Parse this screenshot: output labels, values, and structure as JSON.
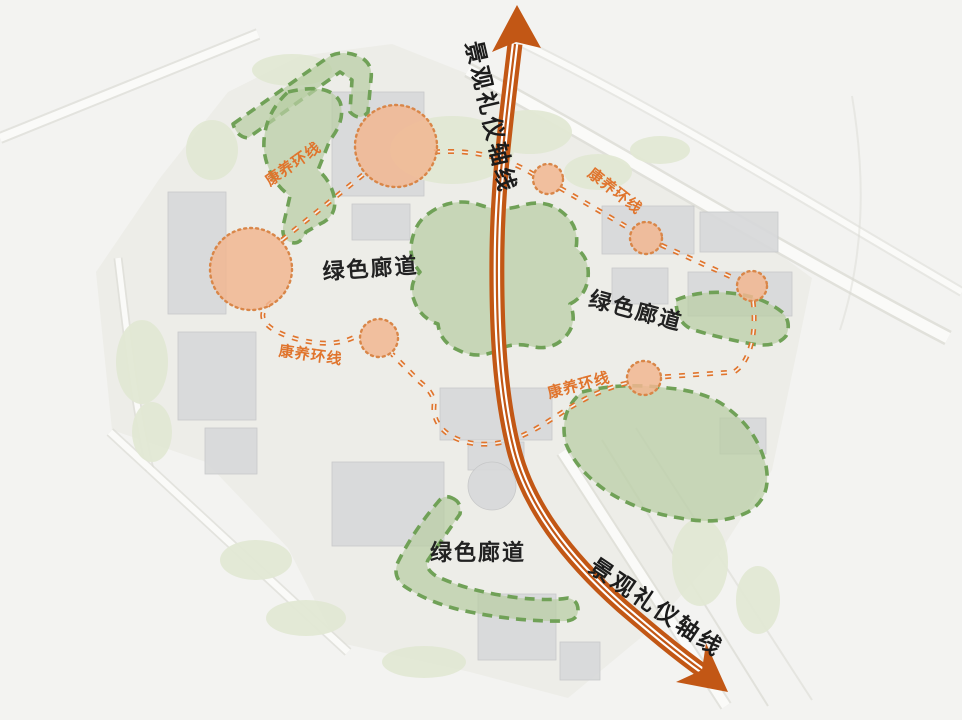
{
  "labels": {
    "axis_top": "景观礼仪轴线",
    "axis_bottom": "景观礼仪轴线",
    "green_corridor_1": "绿色廊道",
    "green_corridor_2": "绿色廊道",
    "green_corridor_3": "绿色廊道",
    "wellness_loop_1": "康养环线",
    "wellness_loop_2": "康养环线",
    "wellness_loop_3": "康养环线",
    "wellness_loop_4": "康养环线"
  },
  "colors": {
    "background": "#f3f3f1",
    "axis": "#c25715",
    "wellness_route": "#e0742c",
    "corridor_fill": "#b8cda3",
    "corridor_border": "#70a157",
    "node_fill": "#f1b691",
    "node_border": "#d98648",
    "label_dark": "#1c1c1c"
  },
  "nodes": [
    {
      "cx": 396,
      "cy": 146,
      "r": 41
    },
    {
      "cx": 251,
      "cy": 269,
      "r": 41
    },
    {
      "cx": 548,
      "cy": 179,
      "r": 15
    },
    {
      "cx": 646,
      "cy": 238,
      "r": 16
    },
    {
      "cx": 752,
      "cy": 286,
      "r": 15
    },
    {
      "cx": 379,
      "cy": 338,
      "r": 19
    },
    {
      "cx": 644,
      "cy": 378,
      "r": 17
    }
  ]
}
